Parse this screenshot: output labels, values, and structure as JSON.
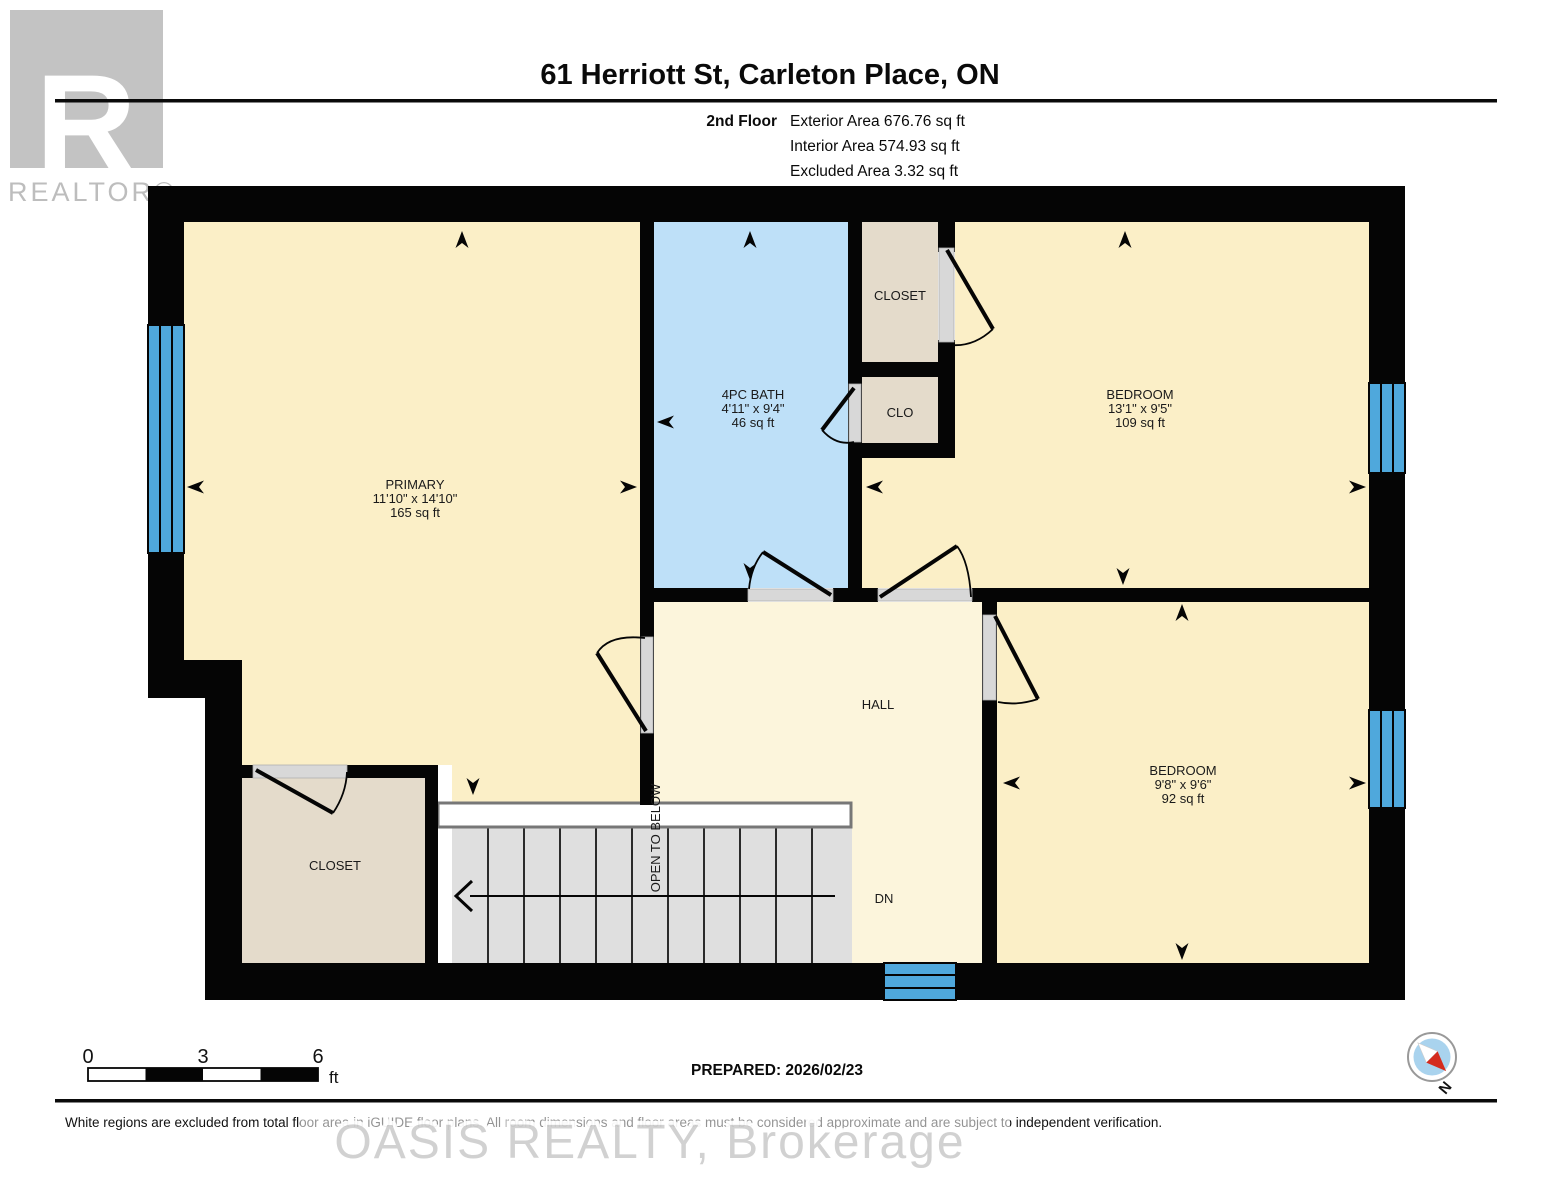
{
  "header": {
    "title": "61 Herriott St, Carleton Place, ON",
    "floor_label": "2nd Floor",
    "exterior_area": "Exterior Area 676.76 sq ft",
    "interior_area": "Interior Area 574.93 sq ft",
    "excluded_area": "Excluded Area 3.32 sq ft"
  },
  "logo": {
    "letter": "R",
    "brand": "REALTOR®"
  },
  "rooms": {
    "primary": {
      "name": "PRIMARY",
      "dims": "11'10\" x 14'10\"",
      "area": "165 sq ft"
    },
    "bath": {
      "name": "4PC BATH",
      "dims": "4'11\" x 9'4\"",
      "area": "46 sq ft"
    },
    "bedroom1": {
      "name": "BEDROOM",
      "dims": "13'1\" x 9'5\"",
      "area": "109 sq ft"
    },
    "bedroom2": {
      "name": "BEDROOM",
      "dims": "9'8\" x 9'6\"",
      "area": "92 sq ft"
    },
    "hall": {
      "name": "HALL"
    },
    "closet_top": {
      "name": "CLOSET"
    },
    "clo": {
      "name": "CLO"
    },
    "closet_bottom": {
      "name": "CLOSET"
    }
  },
  "stairs": {
    "open_to_below": "OPEN TO BELOW",
    "down_label": "DN"
  },
  "scale_bar": {
    "tick0": "0",
    "tick3": "3",
    "tick6": "6",
    "unit": "ft"
  },
  "prepared_label": "PREPARED: 2026/02/23",
  "compass": {
    "north": "N"
  },
  "footer": {
    "disclaimer": "White regions are excluded from total floor area in iGUIDE floor plans. All room dimensions and floor areas must be considered approximate and are subject to independent verification."
  },
  "watermark": "OASIS REALTY, Brokerage",
  "colors": {
    "room_cream": "#FBEFC7",
    "hall_cream": "#FCF5DC",
    "bath_blue": "#BEE0F8",
    "closet_tan": "#E4DBCB",
    "window_blue": "#4FA8DC",
    "stair_gray": "#DFDFDF",
    "wall_black": "#050505",
    "logo_gray": "#C3C3C3",
    "compass_blue": "#A9D3EE",
    "compass_red": "#D42B1E"
  }
}
